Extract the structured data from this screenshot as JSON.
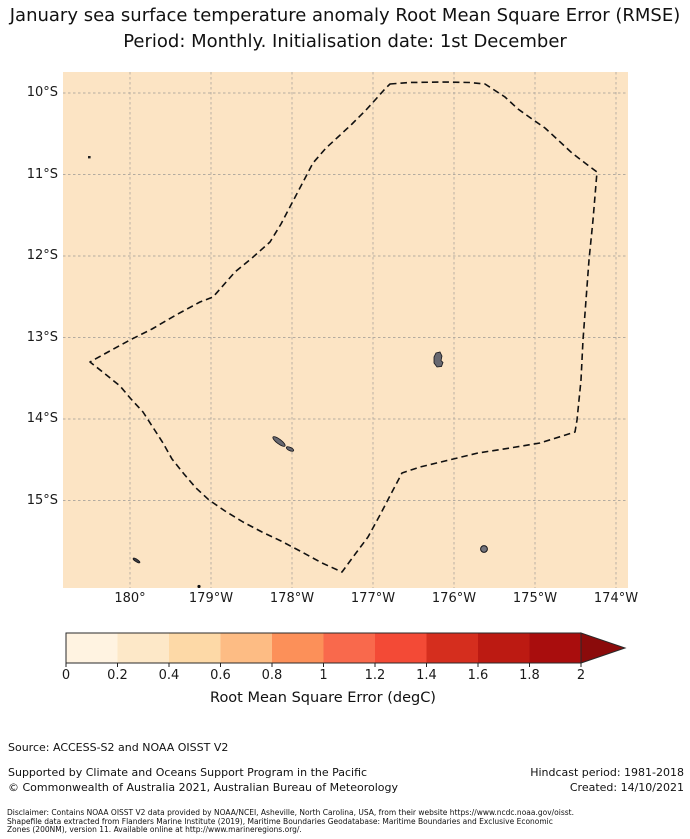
{
  "title": {
    "line1": "January sea surface temperature anomaly Root Mean Square Error (RMSE)",
    "line2": "Period: Monthly. Initialisation date: 1st December"
  },
  "map": {
    "y_tick_labels": [
      "10°S",
      "11°S",
      "12°S",
      "13°S",
      "14°S",
      "15°S"
    ],
    "x_tick_labels": [
      "180°",
      "179°W",
      "178°W",
      "177°W",
      "176°W",
      "175°W",
      "174°W"
    ],
    "ocean_fill_color": "#fce4c4",
    "gridline_color": "#b3aba0",
    "boundary_color": "#111111",
    "island_fill_color": "#686870",
    "island_edge_color": "#15151a"
  },
  "colorbar": {
    "tick_labels": [
      "0",
      "0.2",
      "0.4",
      "0.6",
      "0.8",
      "1",
      "1.2",
      "1.4",
      "1.6",
      "1.8",
      "2"
    ],
    "label": "Root Mean Square Error (degC)",
    "segment_colors": [
      "#fff3e1",
      "#fde8c8",
      "#fdd9a7",
      "#fdbc84",
      "#fc9059",
      "#f9694c",
      "#f34a36",
      "#d52e1e",
      "#bc1a12",
      "#a90d0d"
    ],
    "arrow_color": "#8b0b0b",
    "outline_color": "#2a2a2a"
  },
  "footer": {
    "source": "Source: ACCESS-S2 and NOAA OISST V2",
    "supported": "Supported by Climate and Oceans Support Program in the Pacific",
    "copyright": "© Commonwealth of Australia 2021, Australian Bureau of Meteorology",
    "hindcast": "Hindcast period: 1981-2018",
    "created": "Created: 14/10/2021",
    "disclaimer_line1": "Disclaimer: Contains NOAA OISST V2 data provided by NOAA/NCEI, Asheville, North Carolina, USA, from their website https://www.ncdc.noaa.gov/oisst.",
    "disclaimer_line2": "Shapefile data extracted from Flanders Marine Institute (2019), Maritime Boundaries Geodatabase: Maritime Boundaries and Exclusive Economic",
    "disclaimer_line3": "Zones (200NM), version 11. Available online at http://www.marineregions.org/."
  },
  "chart_data": {
    "type": "heatmap",
    "subtype": "geographic map with filled RMSE field",
    "title": "January sea surface temperature anomaly Root Mean Square Error (RMSE)",
    "subtitle": "Period: Monthly. Initialisation date: 1st December",
    "field": "SST anomaly Root Mean Square Error",
    "units": "degC",
    "x_tick_labels": [
      "180°",
      "179°W",
      "178°W",
      "177°W",
      "176°W",
      "175°W",
      "174°W"
    ],
    "y_tick_labels": [
      "10°S",
      "11°S",
      "12°S",
      "13°S",
      "14°S",
      "15°S"
    ],
    "map_extent": {
      "lon_west": "179.2°E",
      "lon_east": "173.9°W",
      "lat_north": "9.7°S",
      "lat_south": "16.1°S"
    },
    "field_values": "near-uniform, approximately 0.4 degC over the whole shown domain",
    "overlays": [
      "dashed EEZ boundary polygon",
      "small gray island shapes",
      "dashed lat/lon gridlines"
    ],
    "grid": true,
    "colorbar": {
      "label": "Root Mean Square Error (degC)",
      "ticks": [
        0,
        0.2,
        0.4,
        0.6,
        0.8,
        1,
        1.2,
        1.4,
        1.6,
        1.8,
        2
      ],
      "range": [
        0,
        2
      ],
      "extend": "max",
      "orientation": "horizontal",
      "colors": [
        "#fff3e1",
        "#fde8c8",
        "#fdd9a7",
        "#fdbc84",
        "#fc9059",
        "#f9694c",
        "#f34a36",
        "#d52e1e",
        "#bc1a12",
        "#a90d0d",
        "#8b0b0b"
      ]
    }
  }
}
